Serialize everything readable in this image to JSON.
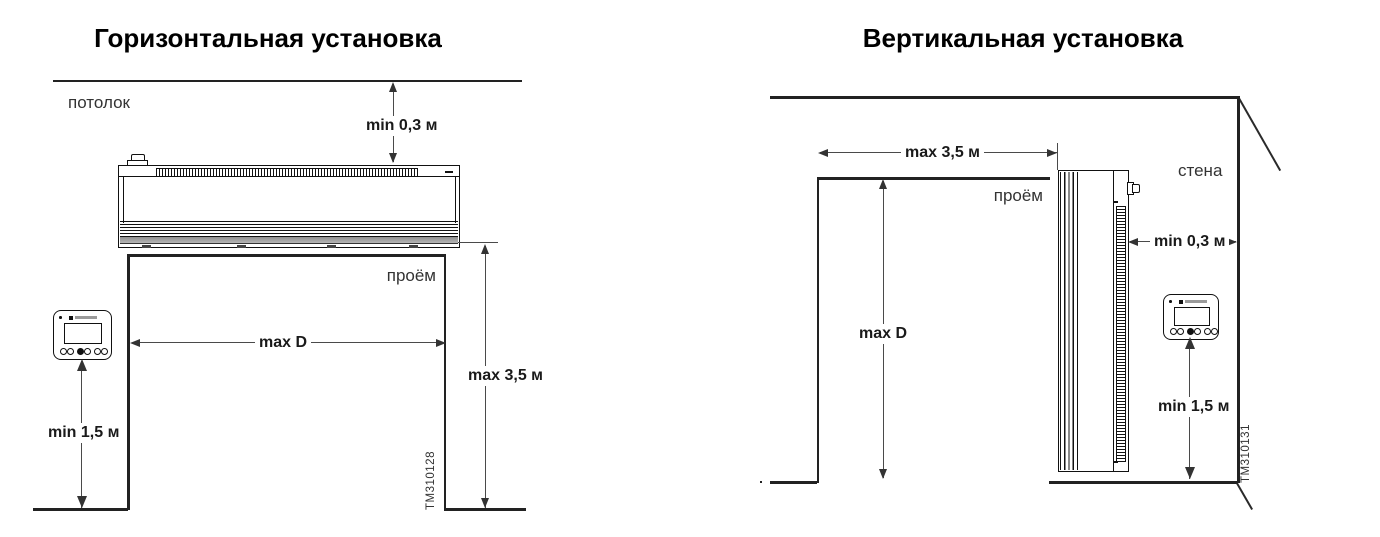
{
  "page": {
    "background": "#ffffff"
  },
  "colors": {
    "line": "#222222",
    "dim_line": "#4a4a4a",
    "text": "#1a1a1a",
    "muted_text": "#333333"
  },
  "left_diagram": {
    "title": "Горизонтальная установка",
    "ceiling_label": "потолок",
    "opening_label": "проём",
    "dim_ceiling_gap": "min 0,3 м",
    "dim_opening_width": "max D",
    "dim_opening_height": "max 3,5 м",
    "dim_controller_height": "min 1,5 м",
    "figure_id": "TM310128"
  },
  "right_diagram": {
    "title": "Вертикальная установка",
    "wall_label": "стена",
    "opening_label": "проём",
    "dim_opening_width": "max 3,5 м",
    "dim_opening_height": "max D",
    "dim_wall_gap": "min 0,3 м",
    "dim_controller_height": "min 1,5 м",
    "figure_id": "TM310131"
  },
  "icons": {
    "brand_logo": "manufacturer logo strip on controller",
    "led_dot": "status dot on controller",
    "cable_gland": "round knob on air-curtain casing"
  }
}
